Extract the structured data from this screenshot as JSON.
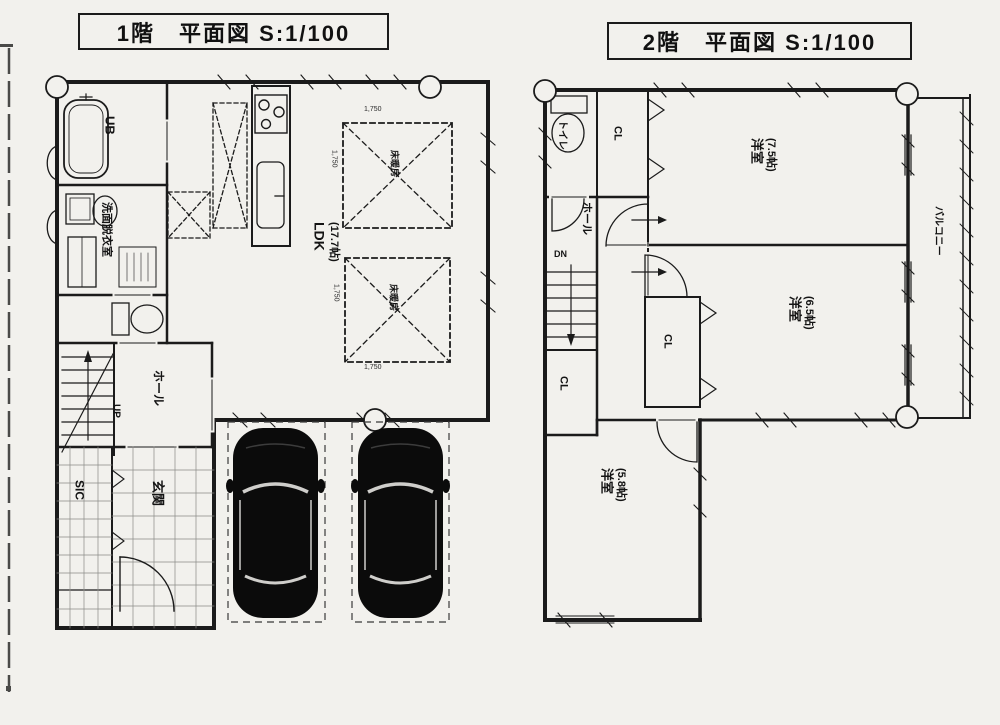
{
  "titles": {
    "floor1": "1階　平面図 S:1/100",
    "floor2": "2階　平面図 S:1/100"
  },
  "floor1": {
    "ub": "UB",
    "senmen": "洗面脱衣室",
    "hall": "ホール",
    "up": "UP",
    "sic": "SIC",
    "genkan": "玄関",
    "ldk": {
      "name": "LDK",
      "size": "(17.7帖)"
    },
    "heating1": {
      "label": "床暖房",
      "dim_top": "1,750",
      "dim_left": "1,750"
    },
    "heating2": {
      "label": "床暖房",
      "dim_left": "1,750",
      "dim_bottom": "1,750"
    }
  },
  "floor2": {
    "toilet": "トイレ",
    "cl_upper": "CL",
    "hall": "ホール",
    "dn": "DN",
    "cl_stairs": "CL",
    "cl_middle": "CL",
    "room_75": {
      "name": "洋室",
      "size": "(7.5帖)"
    },
    "room_65": {
      "name": "洋室",
      "size": "(6.5帖)"
    },
    "room_58": {
      "name": "洋室",
      "size": "(5.8帖)"
    },
    "balcony": "バルコニー"
  }
}
